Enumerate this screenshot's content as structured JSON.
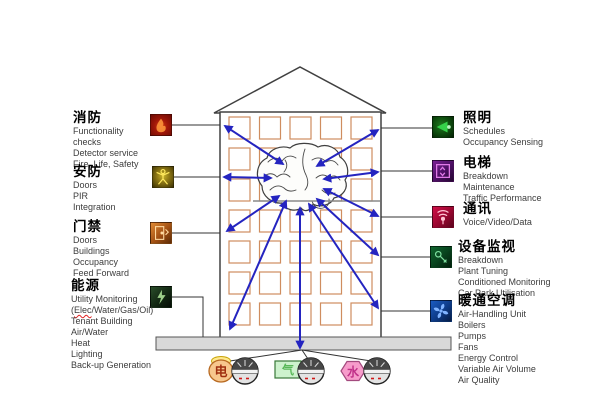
{
  "diagram_title": "Intelligent building management systems diagram",
  "left_systems": [
    {
      "title": "消防",
      "icon": "fire-icon",
      "items": [
        "Functionality",
        "checks",
        "Detector service",
        "Fire, Life, Safety"
      ]
    },
    {
      "title": "安防",
      "icon": "security-icon",
      "items": [
        "Doors",
        "PIR",
        "Integration"
      ]
    },
    {
      "title": "门禁",
      "icon": "access-icon",
      "items": [
        "Doors",
        "Buildings",
        "Occupancy",
        "Feed Forward"
      ]
    },
    {
      "title": "能源",
      "icon": "energy-icon",
      "items": [
        "Utility Monitoring",
        "(Elec/Water/Gas/Oil)",
        "Tenant Building",
        "Air/Water",
        "Heat",
        "Lighting",
        "Back-up Generation"
      ],
      "line2_parts": {
        "open": "(",
        "word": "Elec",
        "rest": "/Water/Gas/Oil)"
      }
    }
  ],
  "right_systems": [
    {
      "title": "照明",
      "icon": "lighting-icon",
      "items": [
        "Schedules",
        "Occupancy Sensing"
      ]
    },
    {
      "title": "电梯",
      "icon": "elevator-icon",
      "items": [
        "Breakdown",
        "Maintenance",
        "Traffic Performance"
      ]
    },
    {
      "title": "通讯",
      "icon": "comms-icon",
      "items": [
        "Voice/Video/Data"
      ]
    },
    {
      "title": "设备监视",
      "icon": "equipment-icon",
      "items": [
        "Breakdown",
        "Plant Tuning",
        "Conditioned Monitoring",
        "Car Park Utilisation"
      ]
    },
    {
      "title": "暖通空调",
      "icon": "hvac-icon",
      "items": [
        "Air-Handling Unit",
        "Boilers",
        "Pumps",
        "Fans",
        "Energy Control",
        "Variable Air Volume",
        "Air Quality"
      ]
    }
  ],
  "meters": [
    {
      "label": "电",
      "name": "electricity-meter"
    },
    {
      "label": "气",
      "name": "gas-meter"
    },
    {
      "label": "水",
      "name": "water-meter"
    }
  ],
  "colors": {
    "arrow_blue": "#2424c0",
    "window_orange": "#cf8d5f",
    "building_outline": "#404040",
    "base_gray": "#d9d9d9",
    "text_gray": "#3d3d3d",
    "spellcheck_red": "#e02020"
  }
}
